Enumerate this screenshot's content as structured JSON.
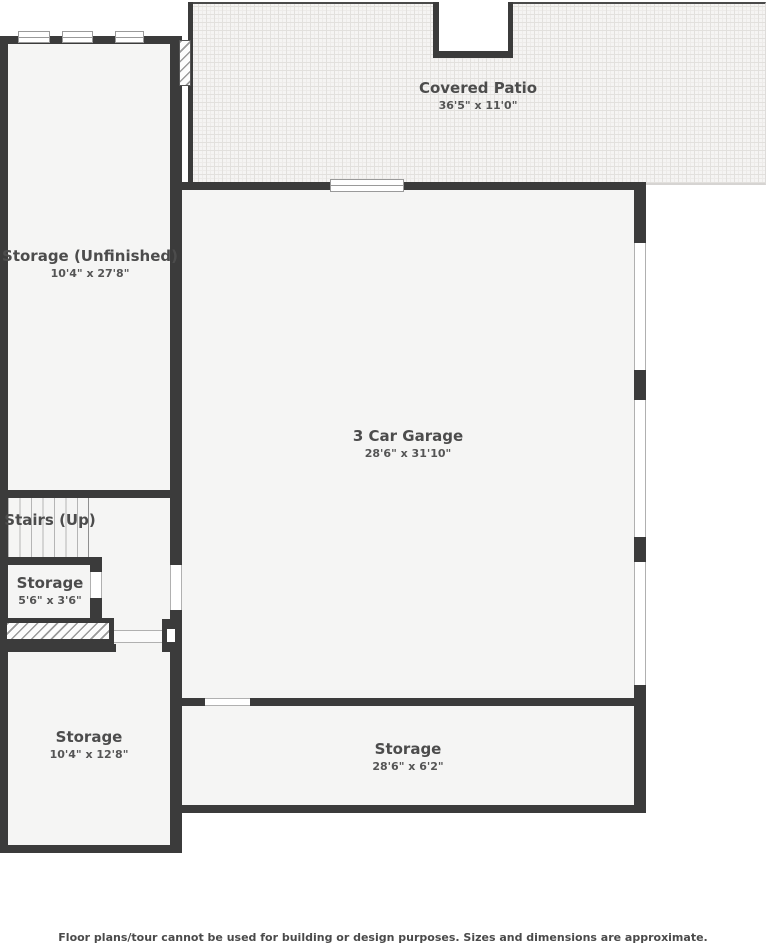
{
  "floor_plan": {
    "rooms": [
      {
        "name": "Covered Patio",
        "dims": "36'5\" x 11'0\""
      },
      {
        "name": "Storage (Unfinished)",
        "dims": "10'4\" x 27'8\""
      },
      {
        "name": "3 Car Garage",
        "dims": "28'6\" x 31'10\""
      },
      {
        "name": "Stairs (Up)",
        "dims": ""
      },
      {
        "name": "Storage",
        "dims": "5'6\" x 3'6\""
      },
      {
        "name": "Storage",
        "dims": "10'4\" x 12'8\""
      },
      {
        "name": "Storage",
        "dims": "28'6\" x 6'2\""
      }
    ],
    "disclaimer": "Floor plans/tour cannot be used for building or design purposes. Sizes and dimensions are approximate.",
    "colors": {
      "wall": "#3b3b3b",
      "room_fill": "#f5f5f4",
      "patio_fill": "#f5f4f3",
      "text": "#4c4c4c",
      "outside": "#ffffff"
    }
  }
}
